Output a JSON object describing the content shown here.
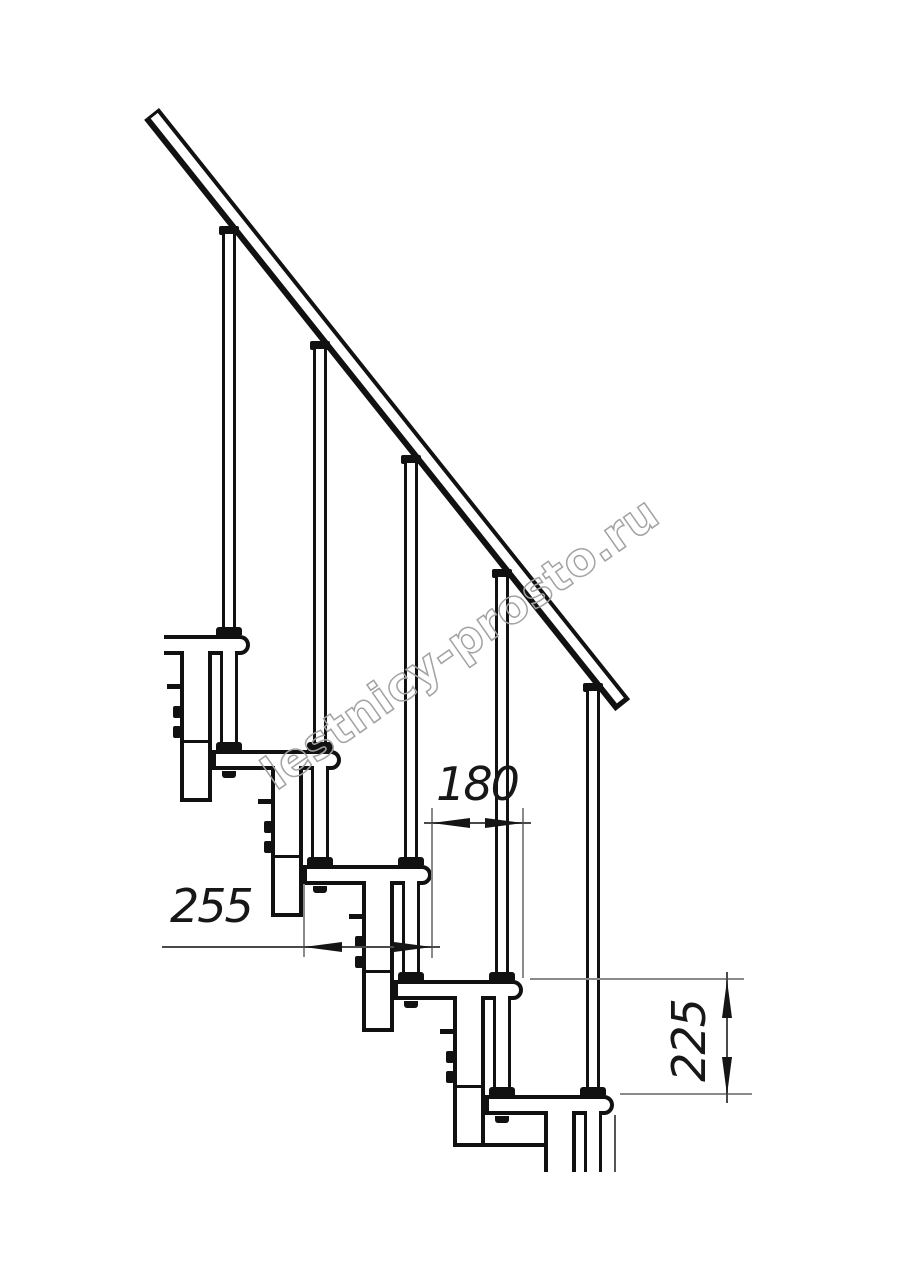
{
  "watermark": {
    "text": "lestnicy-prosto.ru",
    "stroke_color": "#a2a2a2"
  },
  "dimensions": {
    "run_label": "180",
    "tread_depth_label": "255",
    "rise_label": "225"
  },
  "drawing": {
    "type": "modular-staircase-side-elevation",
    "line_color": "#111111",
    "dim_line_color": "#4a4a4a",
    "ext_line_color": "#8a8a8a",
    "dim_text_color": "#171717",
    "background": "#ffffff",
    "geometry": {
      "steps": 5,
      "tread_top_start": 635,
      "rise": 115,
      "run": 91,
      "tread_height": 20,
      "tread_right_start": 250,
      "tread_left_first": 164,
      "axis_start": 229,
      "box_left_start": 180,
      "box_width": 32,
      "box_below_next_tread": 52,
      "cut_bottom_y": 1172,
      "rail": {
        "x": 159,
        "y": 108,
        "length": 756,
        "thickness": 19,
        "angle_deg": 51.45,
        "corner_x": 144.1,
        "corner_y": 119.8,
        "slope": 1.2549
      }
    }
  }
}
